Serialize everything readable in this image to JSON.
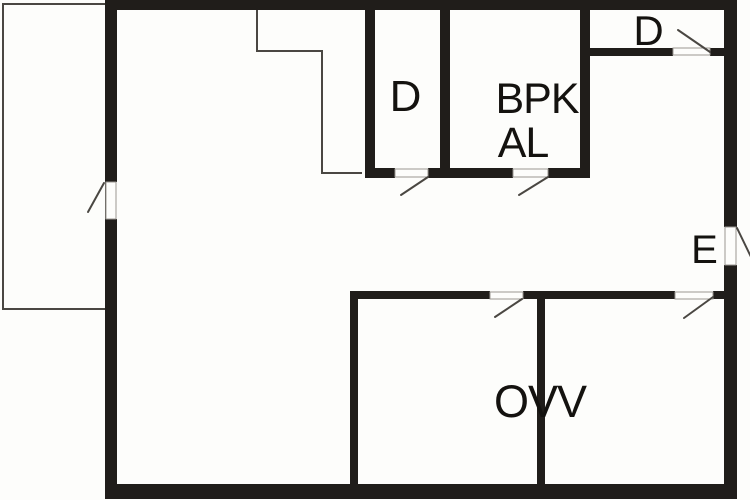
{
  "title": "floor-plan",
  "colors": {
    "background": "#fdfdfb",
    "wall": "#201d1a",
    "thin_line": "#4a4742",
    "threshold_edge": "#9a9792",
    "label": "#14120f",
    "threshold_fill": "#fdfdfb"
  },
  "rooms": {
    "bedroom_d": {
      "label": "D"
    },
    "bpk": {
      "label": "BPK"
    },
    "al": {
      "label": "AL"
    },
    "entry_d": {
      "label": "D"
    },
    "entrance_e": {
      "label": "E"
    },
    "ovv": {
      "label": "OVV"
    }
  }
}
